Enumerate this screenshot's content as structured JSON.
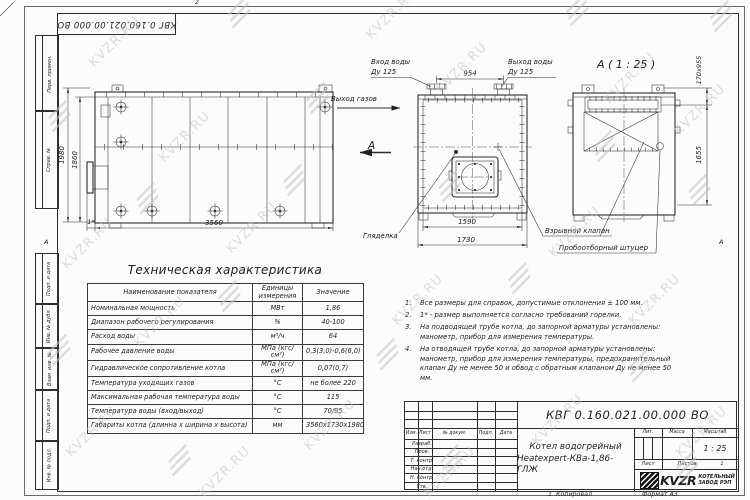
{
  "sheet": {
    "designation_top": "КВГ 0.160.021.00.000 ВО",
    "zone_top": "2",
    "zone_bottom": "1",
    "zone_left": "А",
    "zone_right": "А",
    "footer_copied": "Копировал",
    "footer_format": "Формат А3"
  },
  "margin_stamps": {
    "top": [
      "Перв. примен.",
      "Справ. №"
    ],
    "bottom": [
      "Подп. и дата",
      "Инв. № дубл.",
      "Взам. инв. №",
      "Подп. и дата",
      "Инв. № подл."
    ]
  },
  "watermark": {
    "text": "KVZR.RU",
    "color": "#c2c2c2",
    "items": [
      {
        "x": 115,
        "y": 42,
        "t": "t"
      },
      {
        "x": 392,
        "y": 14,
        "t": "t"
      },
      {
        "x": 462,
        "y": 68,
        "t": "t"
      },
      {
        "x": 630,
        "y": 78,
        "t": "t"
      },
      {
        "x": 185,
        "y": 137,
        "t": "t"
      },
      {
        "x": 700,
        "y": 110,
        "t": "t"
      },
      {
        "x": 88,
        "y": 244,
        "t": "t"
      },
      {
        "x": 252,
        "y": 228,
        "t": "t"
      },
      {
        "x": 575,
        "y": 232,
        "t": "t"
      },
      {
        "x": 160,
        "y": 322,
        "t": "t"
      },
      {
        "x": 418,
        "y": 300,
        "t": "t"
      },
      {
        "x": 655,
        "y": 300,
        "t": "t"
      },
      {
        "x": 92,
        "y": 432,
        "t": "t"
      },
      {
        "x": 330,
        "y": 425,
        "t": "t"
      },
      {
        "x": 558,
        "y": 420,
        "t": "t"
      },
      {
        "x": 702,
        "y": 432,
        "t": "t"
      },
      {
        "x": 450,
        "y": 472,
        "t": "t"
      },
      {
        "x": 225,
        "y": 472,
        "t": "t"
      },
      {
        "x": 240,
        "y": 14,
        "t": "l"
      },
      {
        "x": 578,
        "y": 12,
        "t": "l"
      },
      {
        "x": 722,
        "y": 18,
        "t": "l"
      },
      {
        "x": 60,
        "y": 118,
        "t": "l"
      },
      {
        "x": 318,
        "y": 100,
        "t": "l"
      },
      {
        "x": 605,
        "y": 148,
        "t": "l"
      },
      {
        "x": 148,
        "y": 200,
        "t": "l"
      },
      {
        "x": 450,
        "y": 188,
        "t": "l"
      },
      {
        "x": 700,
        "y": 192,
        "t": "l"
      },
      {
        "x": 230,
        "y": 298,
        "t": "l"
      },
      {
        "x": 520,
        "y": 280,
        "t": "l"
      },
      {
        "x": 60,
        "y": 352,
        "t": "l"
      },
      {
        "x": 388,
        "y": 356,
        "t": "l"
      },
      {
        "x": 640,
        "y": 368,
        "t": "l"
      },
      {
        "x": 180,
        "y": 462,
        "t": "l"
      },
      {
        "x": 452,
        "y": 462,
        "t": "l"
      },
      {
        "x": 688,
        "y": 468,
        "t": "l"
      },
      {
        "x": 295,
        "y": 182,
        "t": "l"
      }
    ]
  },
  "views": {
    "side": {
      "dim_height_outer": "1980",
      "dim_height_inner": "1860",
      "dim_length": "3560",
      "dim_burner": "1*"
    },
    "front": {
      "label_water_in_1": "Вход воды",
      "label_water_in_2": "Ду 125",
      "label_water_out_1": "Выход воды",
      "label_water_out_2": "Ду 125",
      "label_gas_out": "Выход газов",
      "label_view_letter": "А",
      "label_sight_glass": "Гляделка",
      "dim_pipes": "954",
      "dim_width_inner": "1590",
      "dim_width_outer": "1730"
    },
    "section": {
      "title": "А ( 1 : 25 )",
      "label_explosion_valve": "Взрывной клапан",
      "label_sampling_fitting": "Пробоотборный штуцер",
      "dim_hatch": "170х955",
      "dim_height": "1655"
    }
  },
  "spec_table": {
    "title": "Техническая характеристика",
    "headers": [
      "Наименование показателя",
      "Единицы измерения",
      "Значение"
    ],
    "rows": [
      [
        "Номинальная мощность",
        "МВт",
        "1,86"
      ],
      [
        "Диапазон рабочего регулирования",
        "%",
        "40-100"
      ],
      [
        "Расход воды",
        "м³/ч",
        "64"
      ],
      [
        "Рабочее давление воды",
        "МПа (кгс/см²)",
        "0,3(3,0)-0,6(6,0)"
      ],
      [
        "Гидравлическое сопротивление котла",
        "МПа (кгс/см²)",
        "0,07(0,7)"
      ],
      [
        "Температура уходящих газов",
        "°С",
        "не более 220"
      ],
      [
        "Максимальная рабочая температура воды",
        "°С",
        "115"
      ],
      [
        "Температура воды (вход/выход)",
        "°С",
        "70/95"
      ],
      [
        "Габариты котла (длинна х ширина х высота)",
        "мм",
        "3560х1730х1980"
      ]
    ]
  },
  "notes": {
    "items": [
      {
        "num": "1.",
        "text": "Все размеры для справок, допустимые отклонения ± 100 мм."
      },
      {
        "num": "2.",
        "text": "1* - размер выполняется согласно требований горелки."
      },
      {
        "num": "3.",
        "text": "На подводящей трубе котла, до запорной арматуры установлены: манометр, прибор для измерения температуры."
      },
      {
        "num": "4.",
        "text": "На отводящей трубе котла, до запорной арматуры установлены: манометр, прибор для измерения температуры, предохранительный клапан Ду не менее 50 и обвод с обратным клапаном Ду не менее 50 мм."
      }
    ]
  },
  "title_block": {
    "designation": "КВГ 0.160.021.00.000 ВО",
    "name_line1": "Котел водогрейный",
    "name_line2": "Heatexpert-КВа-1,86-ГЛЖ",
    "header_cols": [
      "Изм.",
      "Лист",
      "№ докум.",
      "Подп.",
      "Дата"
    ],
    "staff_rows": [
      "Разраб.",
      "Пров.",
      "Т. контр.",
      "Нач.отд.",
      "Н. контр.",
      "Утв."
    ],
    "lit_label": "Лит.",
    "mass_label": "Масса",
    "scale_label": "Масштаб",
    "scale_value": "1 : 25",
    "sheet_label": "Лист",
    "sheets_label": "Листов",
    "sheets_value": "1",
    "brand": "KVZR",
    "brand_line1": "КОТЕЛЬНЫЙ",
    "brand_line2": "ЗАВОД РЭП"
  }
}
